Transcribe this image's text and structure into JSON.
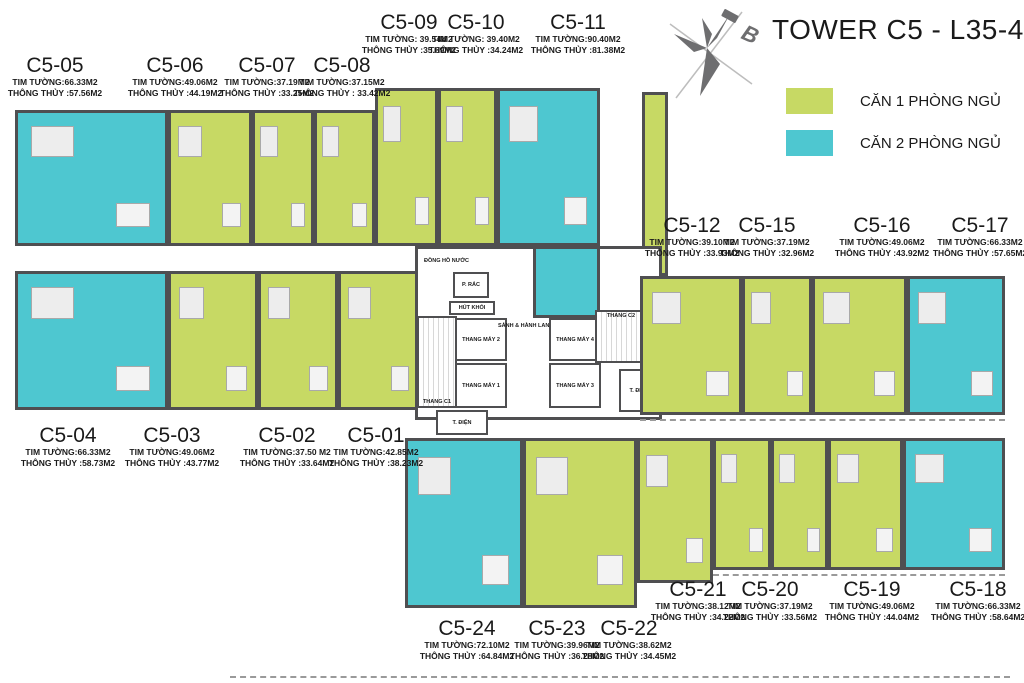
{
  "title": "TOWER C5 - L35-44",
  "compass": {
    "label": "B"
  },
  "legend": {
    "items": [
      {
        "label": "CĂN 1 PHÒNG NGỦ",
        "color": "#c7d964"
      },
      {
        "label": "CĂN 2 PHÒNG NGỦ",
        "color": "#4ec7d0"
      }
    ]
  },
  "colors": {
    "one_bedroom": "#c7d964",
    "two_bedroom": "#4ec7d0",
    "wall": "#4f4f51"
  },
  "units": {
    "c501": {
      "id": "C5-01",
      "bedrooms": 1,
      "tim": "TIM TƯỜNG:42.85M2",
      "thong": "THÔNG THỦY :38.23M2"
    },
    "c502": {
      "id": "C5-02",
      "bedrooms": 1,
      "tim": "TIM TƯỜNG:37.50 M2",
      "thong": "THÔNG THỦY :33.64M2"
    },
    "c503": {
      "id": "C5-03",
      "bedrooms": 1,
      "tim": "TIM TƯỜNG:49.06M2",
      "thong": "THÔNG THỦY :43.77M2"
    },
    "c504": {
      "id": "C5-04",
      "bedrooms": 2,
      "tim": "TIM TƯỜNG:66.33M2",
      "thong": "THÔNG THỦY :58.73M2"
    },
    "c505": {
      "id": "C5-05",
      "bedrooms": 2,
      "tim": "TIM TƯỜNG:66.33M2",
      "thong": "THÔNG THỦY :57.56M2"
    },
    "c506": {
      "id": "C5-06",
      "bedrooms": 1,
      "tim": "TIM TƯỜNG:49.06M2",
      "thong": "THÔNG THỦY :44.19M2"
    },
    "c507": {
      "id": "C5-07",
      "bedrooms": 1,
      "tim": "TIM TƯỜNG:37.19M2",
      "thong": "THÔNG THỦY :33.25M2"
    },
    "c508": {
      "id": "C5-08",
      "bedrooms": 1,
      "tim": "TIM TƯỜNG:37.15M2",
      "thong": "THÔNG THỦY : 33.42M2"
    },
    "c509": {
      "id": "C5-09",
      "bedrooms": 1,
      "tim": "TIM TƯỜNG: 39.54M2",
      "thong": "THÔNG THỦY :35.69M2"
    },
    "c510": {
      "id": "C5-10",
      "bedrooms": 1,
      "tim": "TIM TƯỜNG: 39.40M2",
      "thong": "THÔNG THỦY :34.24M2"
    },
    "c511": {
      "id": "C5-11",
      "bedrooms": 2,
      "tim": "TIM TƯỜNG:90.40M2",
      "thong": "THÔNG THỦY :81.38M2"
    },
    "c512": {
      "id": "C5-12",
      "bedrooms": 1,
      "tim": "TIM TƯỜNG:39.10M2",
      "thong": "THÔNG THỦY :33.93M2"
    },
    "c515": {
      "id": "C5-15",
      "bedrooms": 1,
      "tim": "TIM TƯỜNG:37.19M2",
      "thong": "THÔNG THỦY :32.96M2"
    },
    "c516": {
      "id": "C5-16",
      "bedrooms": 1,
      "tim": "TIM TƯỜNG:49.06M2",
      "thong": "THÔNG THỦY :43.92M2"
    },
    "c517": {
      "id": "C5-17",
      "bedrooms": 2,
      "tim": "TIM TƯỜNG:66.33M2",
      "thong": "THÔNG THỦY :57.65M2"
    },
    "c518": {
      "id": "C5-18",
      "bedrooms": 2,
      "tim": "TIM TƯỜNG:66.33M2",
      "thong": "THÔNG THỦY :58.64M2"
    },
    "c519": {
      "id": "C5-19",
      "bedrooms": 1,
      "tim": "TIM TƯỜNG:49.06M2",
      "thong": "THÔNG THỦY :44.04M2"
    },
    "c520": {
      "id": "C5-20",
      "bedrooms": 1,
      "tim": "TIM TƯỜNG:37.19M2",
      "thong": "THÔNG THỦY :33.56M2"
    },
    "c521": {
      "id": "C5-21",
      "bedrooms": 1,
      "tim": "TIM TƯỜNG:38.12M2",
      "thong": "THÔNG THỦY :34.22M2"
    },
    "c522": {
      "id": "C5-22",
      "bedrooms": 1,
      "tim": "TIM TƯỜNG:38.62M2",
      "thong": "THÔNG THỦY :34.45M2"
    },
    "c523": {
      "id": "C5-23",
      "bedrooms": 1,
      "tim": "TIM TƯỜNG:39.96M2",
      "thong": "THÔNG THỦY :36.28M2"
    },
    "c524": {
      "id": "C5-24",
      "bedrooms": 2,
      "tim": "TIM TƯỜNG:72.10M2",
      "thong": "THÔNG THỦY :64.84M2"
    }
  },
  "core": {
    "water_meter": "ĐỒNG HỒ NƯỚC",
    "trash_room": "P. RÁC",
    "smoke_extract": "HÚT KHÓI",
    "elevator_1": "THANG MÁY 1",
    "elevator_2": "THANG MÁY 2",
    "elevator_3": "THANG MÁY 3",
    "elevator_4": "THANG MÁY 4",
    "stair_c1": "THANG C1",
    "stair_c2": "THANG C2",
    "lobby": "SẢNH & HÀNH LANG",
    "electrical_room": "T. ĐIỆN",
    "electrical_room_2": "T. ĐIỆN"
  }
}
